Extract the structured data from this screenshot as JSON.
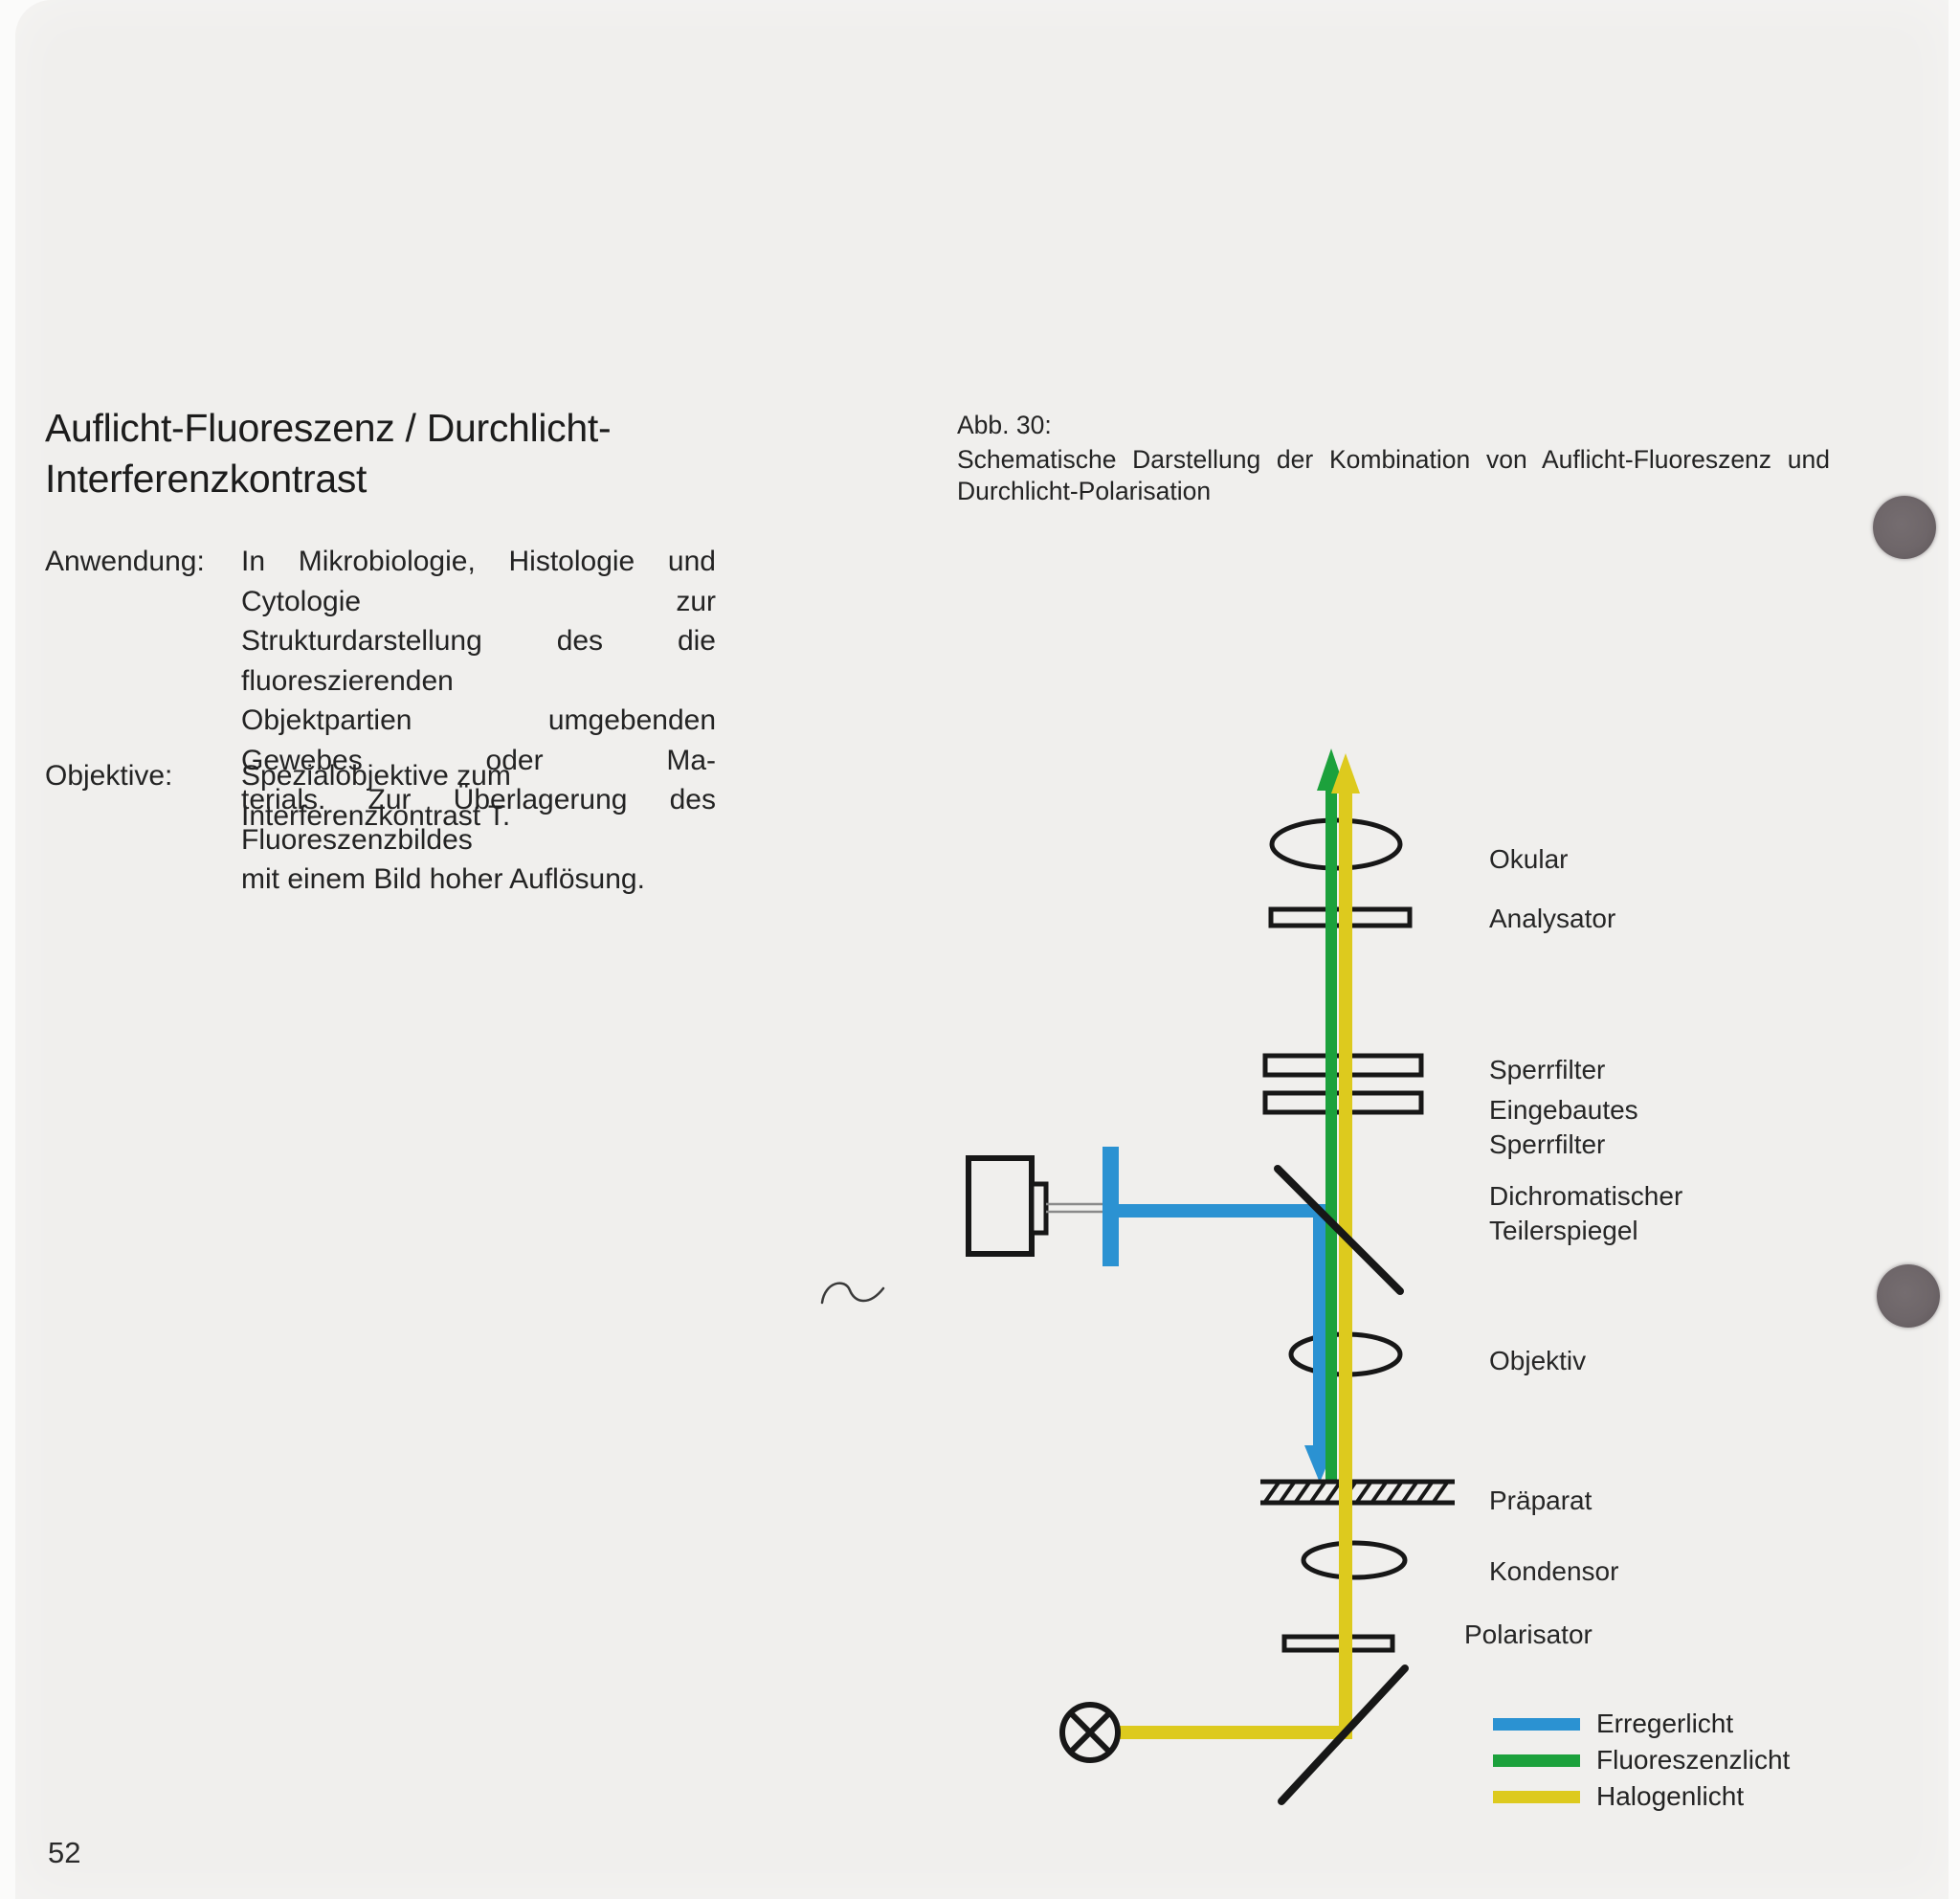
{
  "page": {
    "number": "52",
    "title_lines": [
      "Auflicht-Fluoreszenz / Durchlicht-",
      "Interferenzkontrast"
    ],
    "anwendung_label": "Anwendung:",
    "anwendung_lines": [
      "In Mikrobiologie, Histologie und Cytologie zur",
      "Strukturdarstellung des die fluoreszierenden",
      "Objektpartien umgebenden Gewebes oder Ma-",
      "terials. Zur Überlagerung des Fluoreszenzbildes",
      "mit einem Bild hoher Auflösung."
    ],
    "objektive_label": "Objektive:",
    "objektive_text": "Spezialobjektive zum Interferenzkontrast T."
  },
  "figure": {
    "caption_label": "Abb. 30:",
    "caption_lines": [
      "Schematische Darstellung der Kombination von Auflicht-Fluoreszenz und",
      "Durchlicht-Polarisation"
    ],
    "labels": {
      "okular": "Okular",
      "analysator": "Analysator",
      "sperrfilter": "Sperrfilter",
      "eingebautes_sperrfilter": "Eingebautes\nSperrfilter",
      "dichromatischer_teilerspiegel": "Dichromatischer\nTeilerspiegel",
      "objektiv": "Objektiv",
      "praeparat": "Präparat",
      "kondensor": "Kondensor",
      "polarisator": "Polarisator"
    },
    "legend": [
      {
        "label": "Erregerlicht",
        "color": "#2b92d2"
      },
      {
        "label": "Fluoreszenzlicht",
        "color": "#1ca13c"
      },
      {
        "label": "Halogenlicht",
        "color": "#ddca1e"
      }
    ],
    "diagram_colors": {
      "outline": "#171717",
      "paper": "#f0efed",
      "connector_gray": "#8a8a8a"
    }
  }
}
